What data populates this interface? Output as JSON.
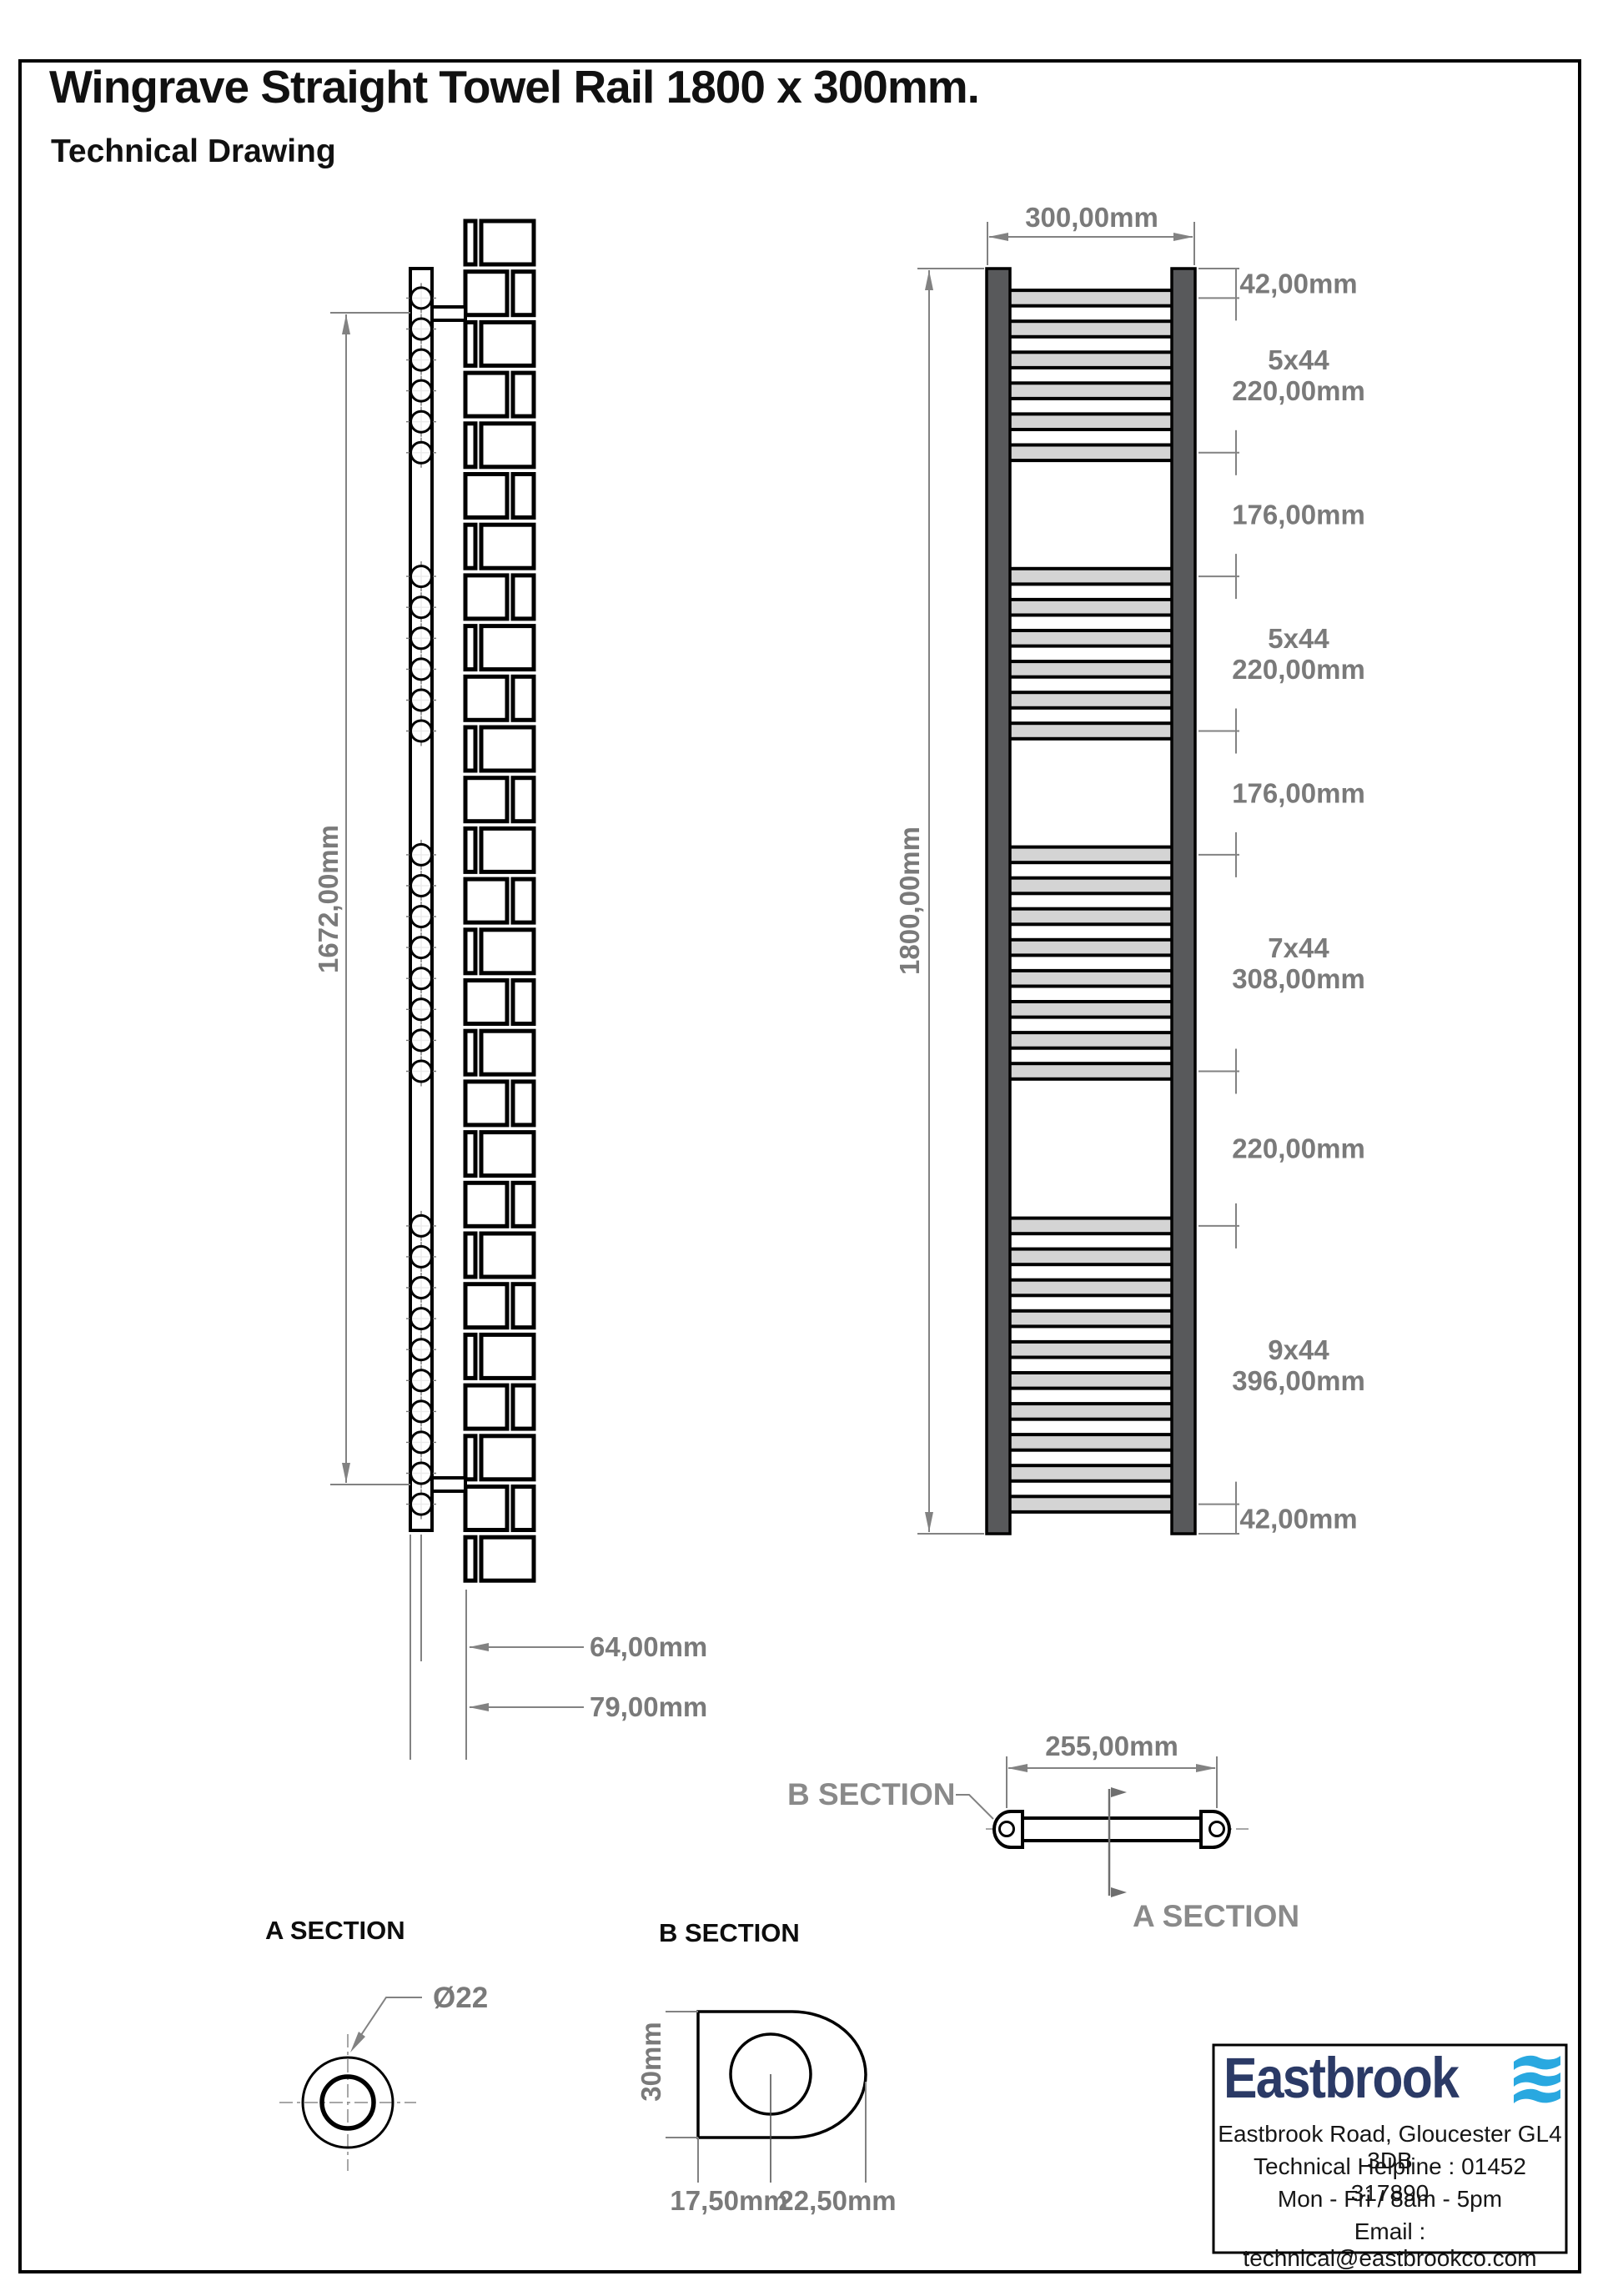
{
  "title": "Wingrave Straight Towel Rail 1800 x 300mm.",
  "subtitle": "Technical Drawing",
  "side_view": {
    "height_dim": "1672,00mm",
    "center_dim": "64,00mm",
    "depth_dim": "79,00mm",
    "screw_groups": [
      6,
      6,
      8,
      10
    ]
  },
  "front_view": {
    "width_dim": "300,00mm",
    "height_dim": "1800,00mm",
    "tube_groups": [
      6,
      6,
      8,
      10
    ],
    "segments": [
      {
        "mm": 42,
        "label": "42,00mm"
      },
      {
        "mm": 220,
        "label": "5x44\n220,00mm"
      },
      {
        "mm": 176,
        "label": "176,00mm"
      },
      {
        "mm": 220,
        "label": "5x44\n220,00mm"
      },
      {
        "mm": 176,
        "label": "176,00mm"
      },
      {
        "mm": 308,
        "label": "7x44\n308,00mm"
      },
      {
        "mm": 220,
        "label": "220,00mm"
      },
      {
        "mm": 396,
        "label": "9x44\n396,00mm"
      },
      {
        "mm": 42,
        "label": "42,00mm"
      }
    ]
  },
  "plan_view": {
    "width_dim": "255,00mm",
    "section_b_label": "B SECTION",
    "section_a_label": "A SECTION"
  },
  "section_a": {
    "title": "A SECTION",
    "diameter": "Ø22"
  },
  "section_b": {
    "title": "B SECTION",
    "height": "30mm",
    "offset_left": "17,50mm",
    "offset_right": "22,50mm"
  },
  "footer": {
    "brand": "Eastbrook",
    "address": "Eastbrook Road, Gloucester GL4 3DB",
    "helpline": "Technical Helpline : 01452 317890",
    "hours": "Mon - Fri / 8am - 5pm",
    "email": "Email : technical@eastbrookco.com"
  },
  "colors": {
    "line": "#000000",
    "dim": "#828282",
    "tube_fill": "#d4d4d4",
    "collector_fill": "#58595b",
    "brand_navy": "#2b3a66",
    "brand_blue": "#29a8e0"
  }
}
